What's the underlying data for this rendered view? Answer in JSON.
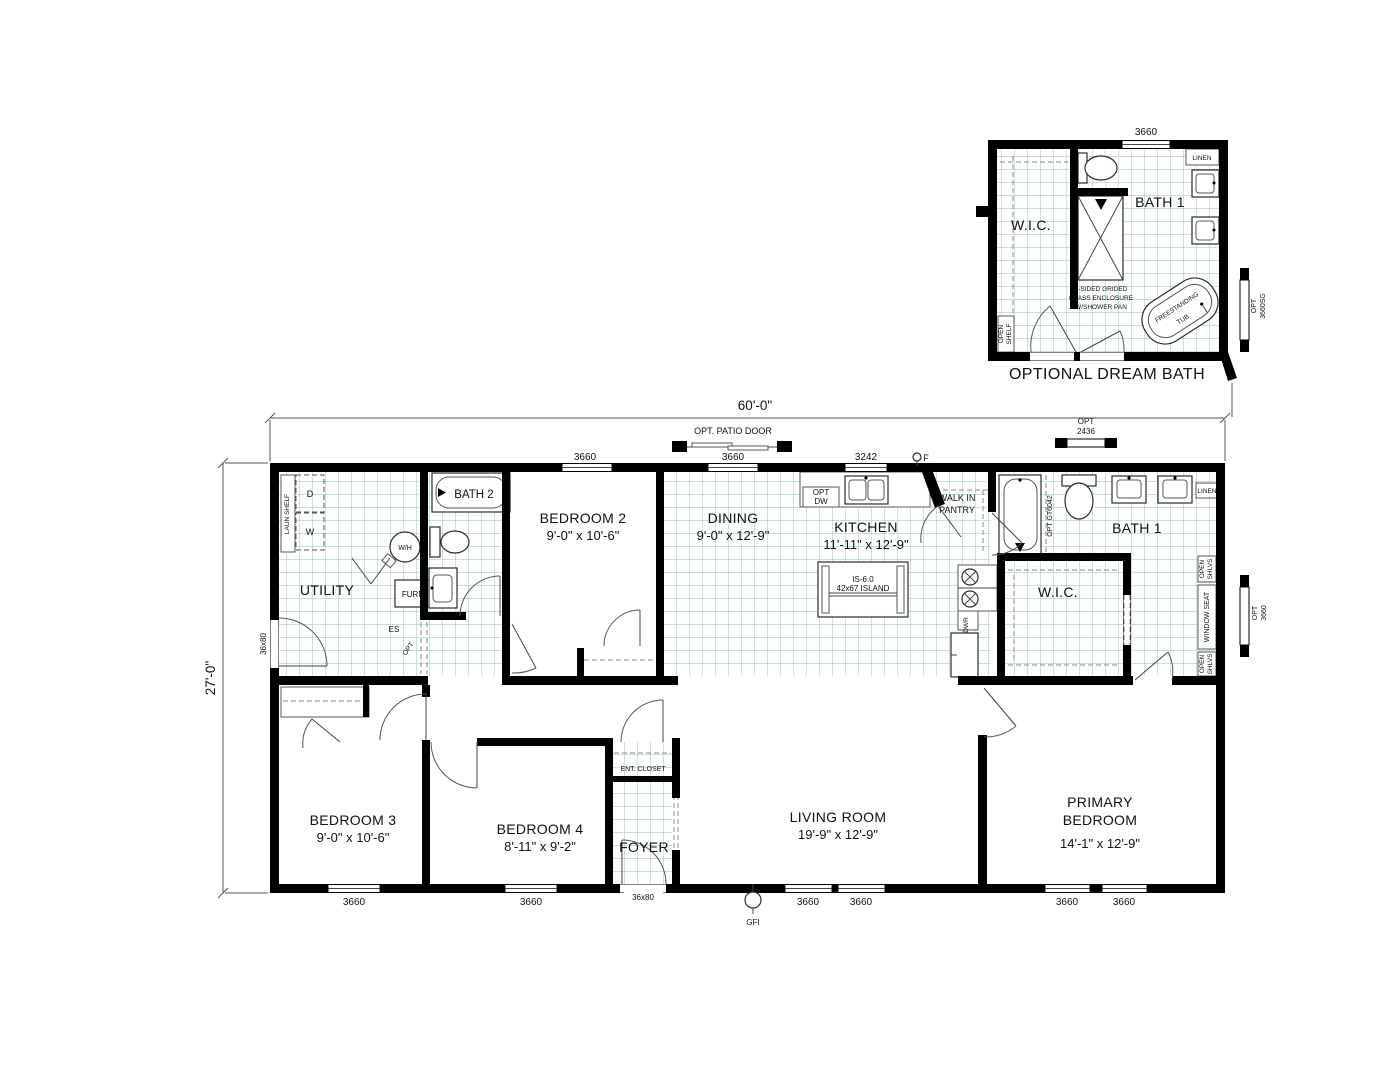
{
  "colors": {
    "wall": "#000000",
    "grid": "#84c9b4",
    "background": "#ffffff"
  },
  "dims": {
    "width": "60'-0\"",
    "height": "27'-0\"",
    "w3660": "3660",
    "w3242": "3242",
    "door36x80": "36x80",
    "patio_door": "OPT. PATIO DOOR",
    "opt2436_l1": "OPT",
    "opt2436_l2": "2436",
    "opt3660_l1": "OPT",
    "opt3660_l2": "3660",
    "gf": "F",
    "gfi": "GFI"
  },
  "dream_bath": {
    "title": "OPTIONAL DREAM BATH",
    "dim_top": "3660",
    "bath1": "BATH 1",
    "wic": "W.I.C.",
    "linen": "LINEN",
    "shower_note1": "2-SIDED GRIDED",
    "shower_note2": "GLASS ENCLOSURE",
    "shower_note3": "W/SHOWER PAN",
    "tub_l1": "FREESTANDING",
    "tub_l2": "TUB",
    "open_l1": "OPEN",
    "open_l2": "SHELF",
    "optwin_l1": "OPT",
    "optwin_l2": "3660SG"
  },
  "rooms": {
    "utility": "UTILITY",
    "bath2": "BATH 2",
    "bedroom2": "BEDROOM 2",
    "bedroom2_size": "9'-0\" x 10'-6\"",
    "dining": "DINING",
    "dining_size": "9'-0\" x 12'-9\"",
    "kitchen": "KITCHEN",
    "kitchen_size": "11'-11\" x 12'-9\"",
    "bath1": "BATH 1",
    "wic": "W.I.C.",
    "bedroom3": "BEDROOM 3",
    "bedroom3_size": "9'-0\" x 10'-6\"",
    "bedroom4": "BEDROOM 4",
    "bedroom4_size": "8'-11\" x 9'-2\"",
    "foyer": "FOYER",
    "ent_closet": "ENT. CLOSET",
    "living": "LIVING ROOM",
    "living_size": "19'-9\" x 12'-9\"",
    "primary_l1": "PRIMARY",
    "primary_l2": "BEDROOM",
    "primary_size": "14'-1\" x 12'-9\""
  },
  "fixtures": {
    "laun_shelf": "LAUN SHELF",
    "washer": "W",
    "dryer": "D",
    "water_heater": "W/H",
    "furnace": "FURN",
    "es": "ES",
    "opt": "OPT",
    "opt_dw_l1": "OPT",
    "opt_dw_l2": "DW",
    "pantry_l1": "WALK IN",
    "pantry_l2": "PANTRY",
    "island_l1": "IS-6.0",
    "island_l2": "42x67 ISLAND",
    "dwr": "DWR",
    "opt_tub": "OPT GT6042",
    "linen": "LINEN",
    "open": "OPEN",
    "shlvs": "SHLVS",
    "window_seat": "WINDOW SEAT"
  }
}
